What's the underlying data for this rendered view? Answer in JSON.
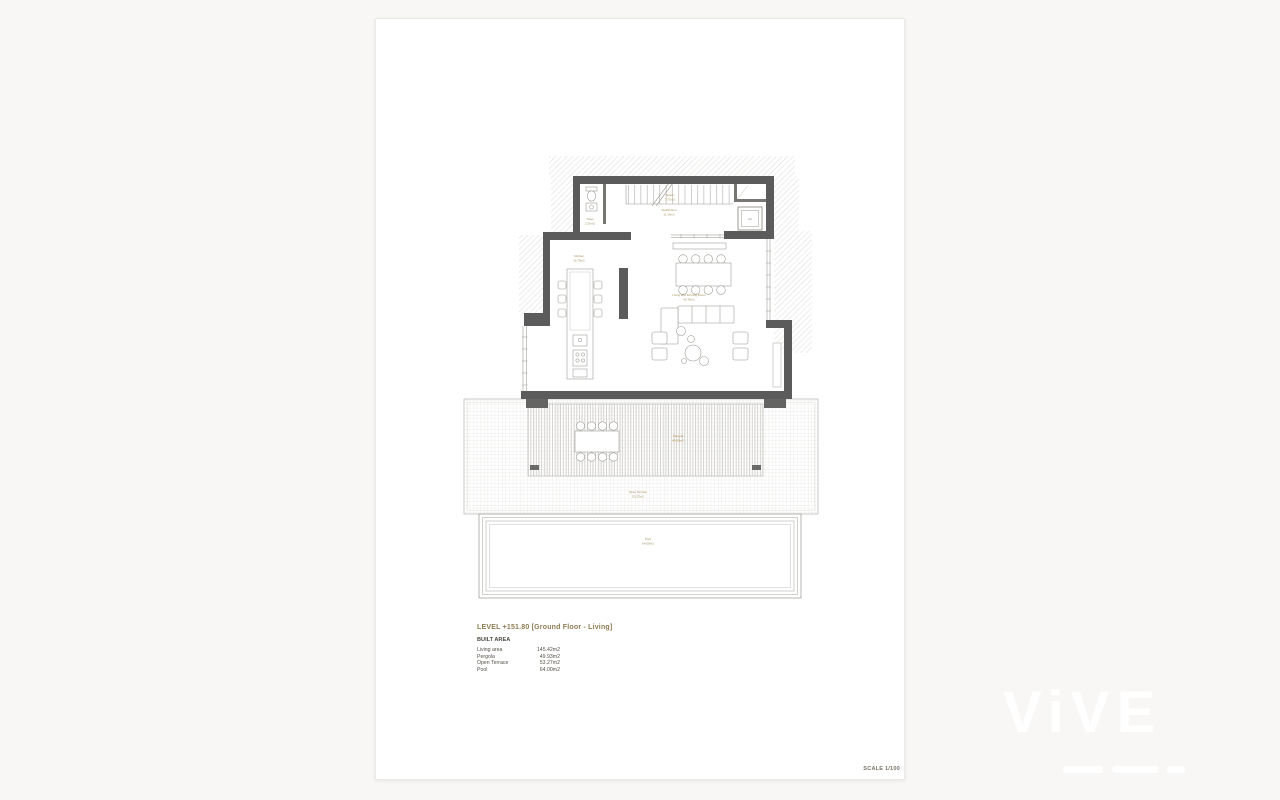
{
  "annotations": {
    "level_title": "LEVEL +151.80 [Ground Floor - Living]",
    "built_area_heading": "BUILT AREA",
    "area_table": [
      {
        "label": "Living area",
        "value": "145.42m2"
      },
      {
        "label": "Pergola",
        "value": "49.93m2"
      },
      {
        "label": "Open Terrace",
        "value": "53.27m2"
      },
      {
        "label": "Pool",
        "value": "64.00m2"
      }
    ],
    "scale": "SCALE 1/100"
  },
  "plan": {
    "rooms": {
      "stairs": {
        "name": "Stairs",
        "area": "3.70m2"
      },
      "toilet": {
        "name": "Toilet",
        "area": "2.50m2"
      },
      "distribution": {
        "name": "Distribution",
        "area": "11.14m2"
      },
      "lift": {
        "name": "Lift"
      },
      "kitchen": {
        "name": "Kitchen",
        "area": "16.70m2"
      },
      "living": {
        "name": "Living and Dinning Room",
        "area": "42.76m2"
      },
      "pergola": {
        "name": "Pergola",
        "area": "49.93m2"
      },
      "open_terrace": {
        "name": "Open Terrace",
        "area": "53.27m2"
      },
      "pool": {
        "name": "Pool",
        "area": "64.00m2"
      }
    }
  },
  "watermark": {
    "logo": "ViVE"
  },
  "colors": {
    "wall": "#5b5b5b",
    "room_label": "#a1905e",
    "title_text": "#8d7c52",
    "page_bg": "#ffffff",
    "canvas_bg": "#f8f7f5"
  }
}
